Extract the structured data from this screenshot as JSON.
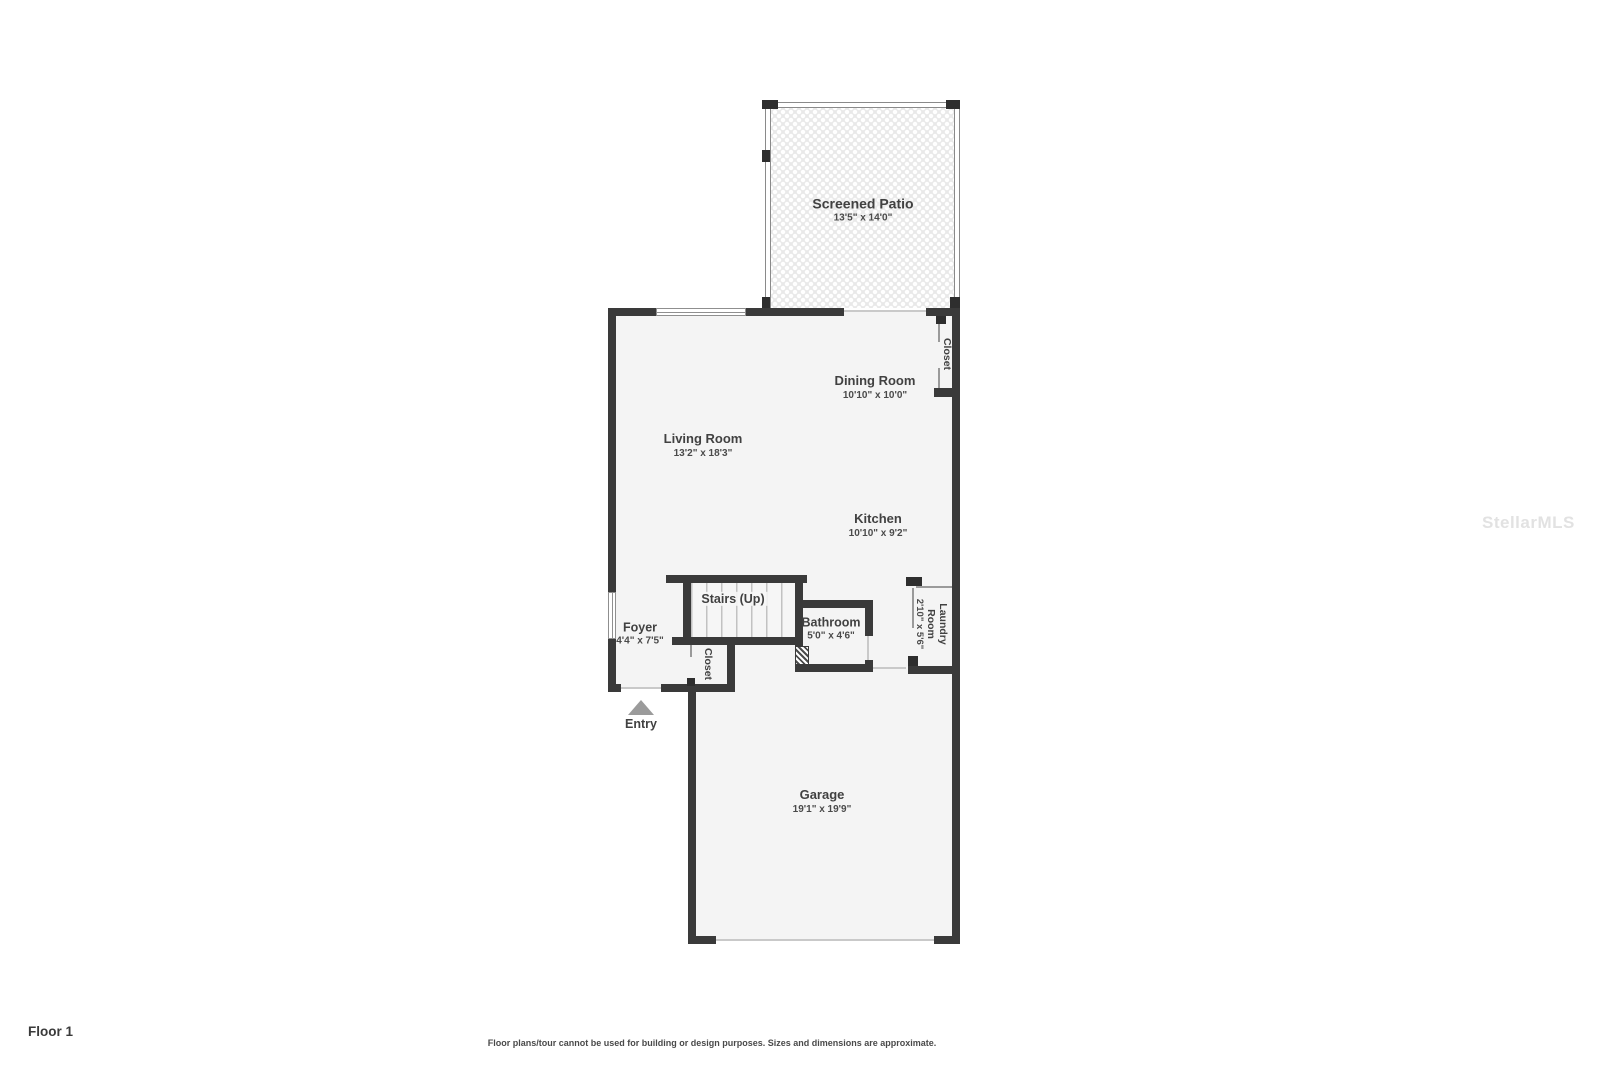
{
  "title": "Floor plan - Floor 1",
  "floor_label": "Floor 1",
  "disclaimer": "Floor plans/tour cannot be used for building or design purposes. Sizes and dimensions are approximate.",
  "watermark": "StellarMLS",
  "colors": {
    "wall": "#3a3a3a",
    "room_fill": "#f4f4f4",
    "label_text": "#414141",
    "entry_arrow": "#9b9b9b",
    "patio_pattern": "#e9e9e9"
  },
  "rooms": [
    {
      "id": "screened_patio",
      "name": "Screened Patio",
      "dims": "13'5\" x 14'0\""
    },
    {
      "id": "dining_room",
      "name": "Dining Room",
      "dims": "10'10\" x 10'0\""
    },
    {
      "id": "living_room",
      "name": "Living Room",
      "dims": "13'2\" x 18'3\""
    },
    {
      "id": "kitchen",
      "name": "Kitchen",
      "dims": "10'10\" x 9'2\""
    },
    {
      "id": "closet_upper",
      "name": "Closet",
      "dims": ""
    },
    {
      "id": "stairs",
      "name": "Stairs (Up)",
      "dims": ""
    },
    {
      "id": "bathroom",
      "name": "Bathroom",
      "dims": "5'0\" x 4'6\""
    },
    {
      "id": "laundry_room",
      "name": "Laundry Room",
      "dims": "2'10\" x 5'6\""
    },
    {
      "id": "foyer",
      "name": "Foyer",
      "dims": "4'4\" x 7'5\""
    },
    {
      "id": "closet_foyer",
      "name": "Closet",
      "dims": ""
    },
    {
      "id": "entry",
      "name": "Entry",
      "dims": ""
    },
    {
      "id": "garage",
      "name": "Garage",
      "dims": "19'1\" x 19'9\""
    }
  ]
}
